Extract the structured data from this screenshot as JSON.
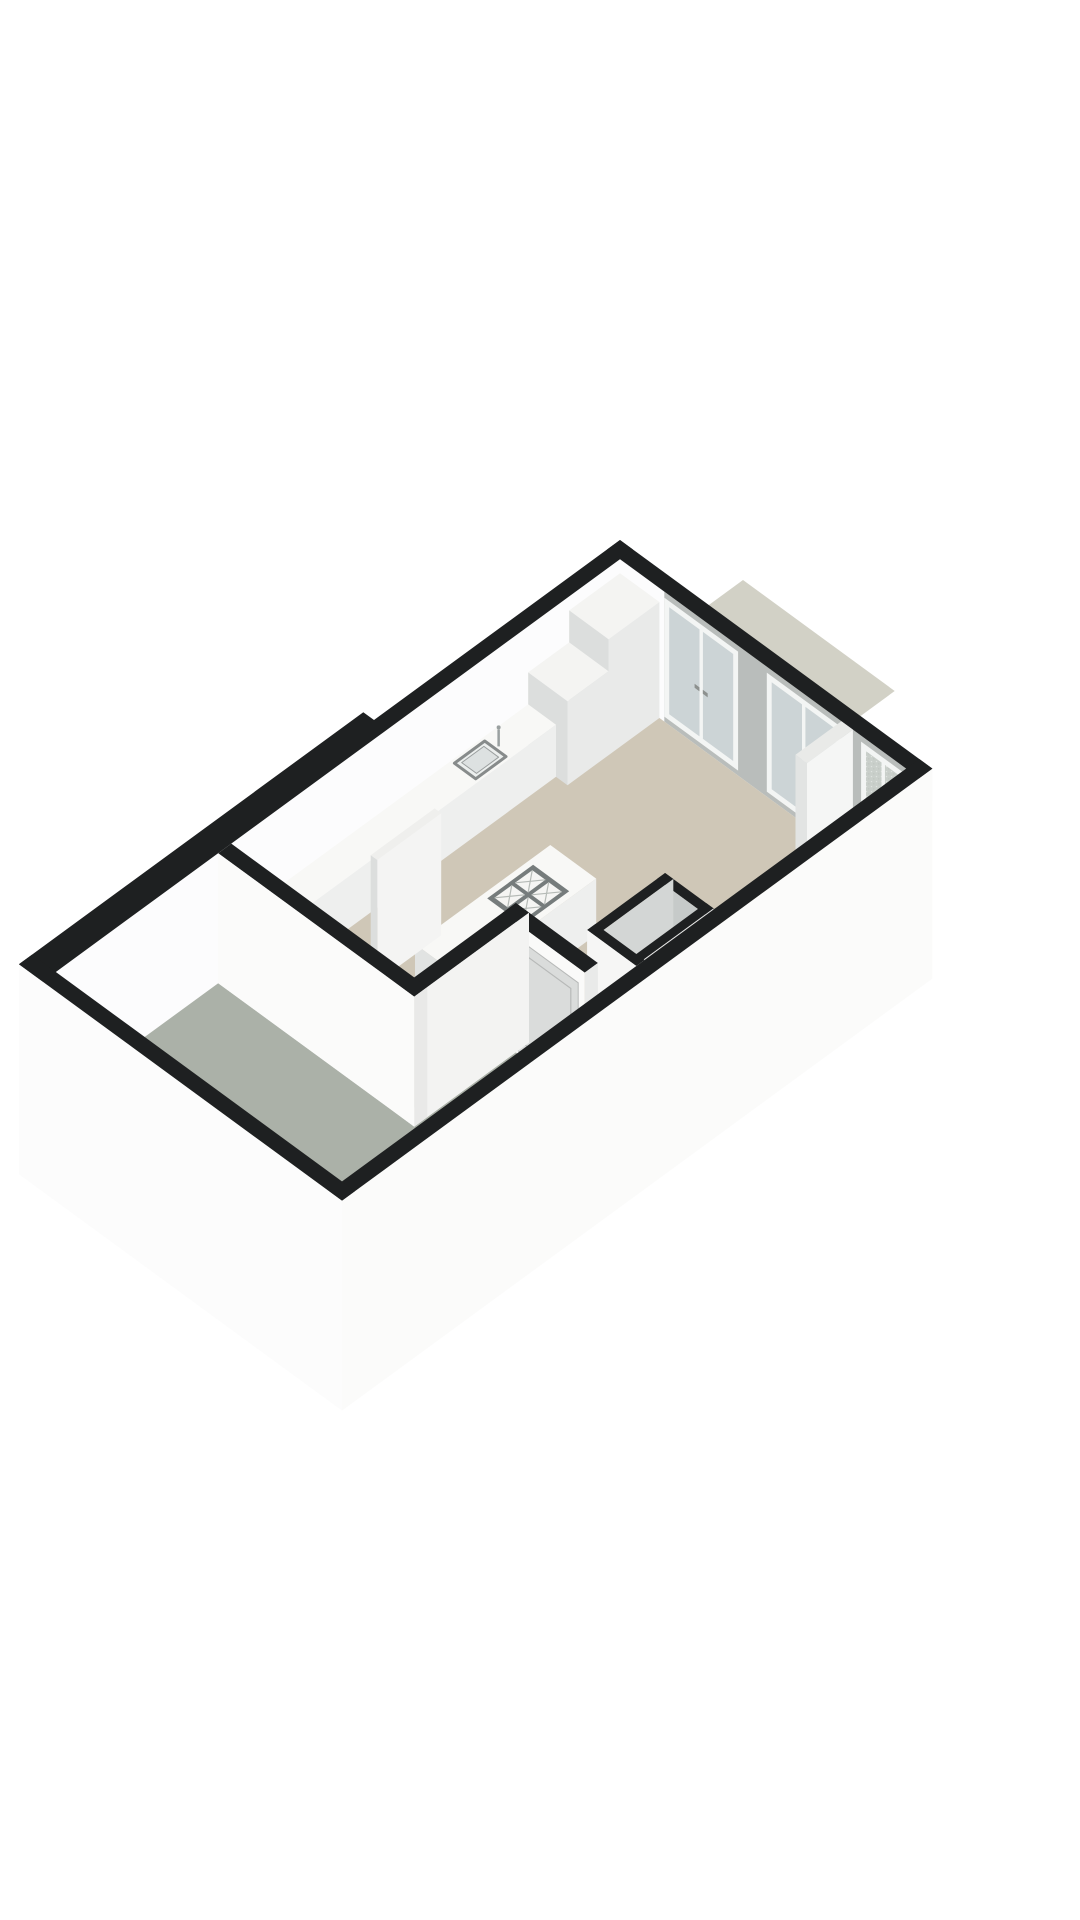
{
  "meta": {
    "description": "3D isometric floor plan render, single floor, no labels",
    "background": "#ffffff"
  },
  "projection": {
    "ox": 620,
    "oy": 670,
    "ux": 0.82,
    "uy": 0.6,
    "vx": -0.82,
    "vy": 0.6,
    "wall_height": 130,
    "ground_drop": 80
  },
  "palette": {
    "wallTop": "#1e2021",
    "wallWhite": "#fcfcfd",
    "wallGrey": "#b9bdbb",
    "wallWhiteOuter": "#fbfbfa",
    "floorBeige": "#cfc7b7",
    "floorGrey": "#abb1a8",
    "terrace": "#d2d1c6",
    "glass": "#ccd4d6",
    "frostBase": "#c9cfca",
    "frameWhite": "#f3f5f4",
    "handleDark": "#8d918f",
    "furnTop": "#f8f8f6",
    "furnRight": "#eeefee",
    "furnFront": "#e1e3e2",
    "closetFloor": "#a3a9a6"
  },
  "elements": [
    {
      "name": "rear-terrace-slab",
      "type": "poly",
      "z": 0,
      "fill": "terrace",
      "pts": [
        [
          0,
          0
        ],
        [
          185,
          0
        ],
        [
          185,
          -150
        ],
        [
          0,
          -150
        ]
      ]
    },
    {
      "name": "window-wall-interior-face",
      "type": "face_v",
      "v": 16,
      "u1": 16,
      "u2": 365,
      "z1": 0,
      "z2": 130,
      "fill": "wallGrey"
    },
    {
      "name": "window-wall-left-section",
      "type": "face_v",
      "v": 16,
      "u1": 16,
      "u2": 70,
      "z1": 0,
      "z2": 130,
      "fill": "wallWhite"
    },
    {
      "name": "french-window-1",
      "type": "window",
      "u1": 70,
      "u2": 160,
      "frosted": false
    },
    {
      "name": "french-window-2",
      "type": "window",
      "u1": 195,
      "u2": 285,
      "frosted": false
    },
    {
      "name": "french-window-3",
      "type": "window",
      "u1": 310,
      "u2": 364,
      "frosted": true
    },
    {
      "name": "window-wall-top",
      "type": "poly",
      "z": 130,
      "fill": "wallTop",
      "pts": [
        [
          0,
          0
        ],
        [
          381,
          0
        ],
        [
          381,
          16
        ],
        [
          0,
          16
        ]
      ]
    },
    {
      "name": "left-wall-interior-face",
      "type": "face_u",
      "u": 16,
      "v1": 16,
      "v2": 704,
      "z1": 0,
      "z2": 130,
      "fill": "wallWhite"
    },
    {
      "name": "left-wall-top",
      "type": "poly",
      "z": 130,
      "fill": "wallTop",
      "pts": [
        [
          0,
          0
        ],
        [
          16,
          0
        ],
        [
          16,
          720
        ],
        [
          -13,
          720
        ],
        [
          -13,
          300
        ],
        [
          0,
          300
        ]
      ]
    },
    {
      "name": "living-room-floor",
      "type": "poly",
      "z": 0,
      "fill": "floorBeige",
      "pts": [
        [
          16,
          16
        ],
        [
          365,
          16
        ],
        [
          365,
          366
        ],
        [
          239,
          366
        ],
        [
          239,
          490
        ],
        [
          16,
          490
        ]
      ]
    },
    {
      "name": "patio-floor",
      "type": "poly",
      "z": 0,
      "fill": "floorGrey",
      "pts": [
        [
          16,
          506
        ],
        [
          255,
          506
        ],
        [
          255,
          382
        ],
        [
          339,
          382
        ],
        [
          339,
          366
        ],
        [
          365,
          366
        ],
        [
          365,
          704
        ],
        [
          16,
          704
        ]
      ]
    },
    {
      "name": "tall-cabinet",
      "type": "box",
      "u1": 16,
      "v1": 16,
      "u2": 64,
      "v2": 78,
      "h": 116,
      "top": "#f4f4f2",
      "right": "#e9eae9",
      "front": "#dcdedd"
    },
    {
      "name": "half-cabinet",
      "type": "box",
      "u1": 16,
      "v1": 78,
      "u2": 64,
      "v2": 128,
      "h": 84,
      "top": "#f4f4f2",
      "right": "#e9eae9",
      "front": "#dcdedd"
    },
    {
      "name": "kitchen-counter",
      "type": "box",
      "u1": 16,
      "v1": 128,
      "u2": 50,
      "v2": 445,
      "h": 52,
      "top": "furnTop",
      "right": "furnRight",
      "front": "furnFront"
    },
    {
      "name": "kitchen-sink",
      "type": "sink",
      "z": 52,
      "outer": [
        20,
        185,
        46,
        222
      ],
      "inner": [
        24,
        190,
        42,
        217
      ],
      "faucet": [
        33,
        181
      ]
    },
    {
      "name": "window-wall-stub",
      "type": "box",
      "u1": 286,
      "v1": 16,
      "u2": 300,
      "v2": 72,
      "h": 130,
      "top": "#e9eae8",
      "right": "#f5f6f5",
      "front": "#e2e4e3"
    },
    {
      "name": "kitchen-island",
      "type": "box",
      "u1": 150,
      "v1": 235,
      "u2": 206,
      "v2": 400,
      "h": 56,
      "top": "furnTop",
      "right": "furnRight",
      "front": "furnFront"
    },
    {
      "name": "island-cooktop",
      "type": "cooktop",
      "z": 56,
      "frame": [
        156,
        262,
        200,
        318
      ],
      "cols": [
        [
          160,
          176
        ],
        [
          180,
          196
        ]
      ],
      "rows": [
        [
          267,
          288
        ],
        [
          292,
          313
        ]
      ],
      "frameFill": "#767c7c",
      "burnerFill": "#f5f5f3",
      "lineStroke": "#b5bab6"
    },
    {
      "name": "island-drawer-knob",
      "type": "dot",
      "u": 178,
      "v": 400,
      "z": 28,
      "r": 2.5,
      "fill": "#9aa09e"
    },
    {
      "name": "freestanding-pillar",
      "type": "box",
      "u1": 104,
      "v1": 330,
      "u2": 112,
      "v2": 408,
      "h": 122,
      "top": "#efefed",
      "right": "#f4f4f3",
      "front": "#dcdedd"
    },
    {
      "name": "closet-floor",
      "type": "poly",
      "z": 0,
      "fill": "closetFloor",
      "pts": [
        [
          315,
          260
        ],
        [
          355,
          260
        ],
        [
          355,
          335
        ],
        [
          315,
          335
        ]
      ]
    },
    {
      "name": "closet-wall-north",
      "type": "box",
      "u1": 305,
      "v1": 250,
      "u2": 365,
      "v2": 260,
      "h": 130,
      "top": "wallTop",
      "right": "#e8e8e7",
      "front": "#c6cac9"
    },
    {
      "name": "closet-wall-west",
      "type": "box",
      "u1": 305,
      "v1": 250,
      "u2": 315,
      "v2": 345,
      "h": 130,
      "top": "wallTop",
      "right": "#d3d6d5",
      "front": "#f1f1f0"
    },
    {
      "name": "closet-wall-east",
      "type": "box",
      "u1": 355,
      "v1": 250,
      "u2": 364,
      "v2": 345,
      "h": 130,
      "top": "wallTop",
      "right": "#e8e8e7",
      "front": "#f1f1f0"
    },
    {
      "name": "closet-wall-south",
      "type": "box",
      "u1": 305,
      "v1": 335,
      "u2": 365,
      "v2": 345,
      "h": 130,
      "top": "wallTop",
      "right": "#e8e8e7",
      "front": "#f6f6f5"
    },
    {
      "name": "door-wall",
      "type": "box",
      "u1": 239,
      "v1": 366,
      "u2": 339,
      "v2": 382,
      "h": 130,
      "top": "wallTop",
      "right": "#e9eae9",
      "front": "#fafaf9"
    },
    {
      "name": "entrance-door",
      "type": "door",
      "v": 382,
      "u1": 247,
      "u2": 331,
      "z1": 3,
      "z2": 115,
      "panelFill": "#dadcdb",
      "panelStroke": "#b7b9b8",
      "innerInset": 9,
      "handle": {
        "u": 258,
        "z": 58,
        "r": 3
      },
      "keyhole": {
        "u": 258,
        "z": 46,
        "r": 1.8
      }
    },
    {
      "name": "door-return-wall",
      "type": "box",
      "u1": 239,
      "v1": 366,
      "u2": 255,
      "v2": 506,
      "h": 130,
      "top": "wallTop",
      "right": "#f3f3f2",
      "front": "#e6e7e6"
    },
    {
      "name": "partition-wall",
      "type": "box",
      "u1": 16,
      "v1": 490,
      "u2": 255,
      "v2": 506,
      "h": 130,
      "top": "wallTop",
      "right": "#e9e9e8",
      "front": "#fbfbfa"
    },
    {
      "name": "entry-step",
      "type": "box",
      "u1": 339,
      "v1": 345,
      "u2": 365,
      "v2": 377,
      "h": 13,
      "top": "#f1f1ef",
      "right": "#eaebe9",
      "front": "#e6e7e6"
    },
    {
      "name": "right-wall-exterior-face",
      "type": "face_u",
      "u": 381,
      "v1": 0,
      "v2": 720,
      "z1": -80,
      "z2": 130,
      "fill": "wallWhiteOuter"
    },
    {
      "name": "right-wall-top",
      "type": "poly",
      "z": 130,
      "fill": "wallTop",
      "pts": [
        [
          365,
          0
        ],
        [
          381,
          0
        ],
        [
          381,
          720
        ],
        [
          365,
          720
        ]
      ]
    },
    {
      "name": "bottom-wall-exterior-face",
      "type": "face_v",
      "v": 720,
      "u1": -13,
      "u2": 381,
      "z1": -80,
      "z2": 130,
      "fill": "#fcfcfc"
    },
    {
      "name": "bottom-wall-top",
      "type": "poly",
      "z": 130,
      "fill": "wallTop",
      "pts": [
        [
          -13,
          704
        ],
        [
          381,
          704
        ],
        [
          381,
          720
        ],
        [
          -13,
          720
        ]
      ]
    }
  ]
}
